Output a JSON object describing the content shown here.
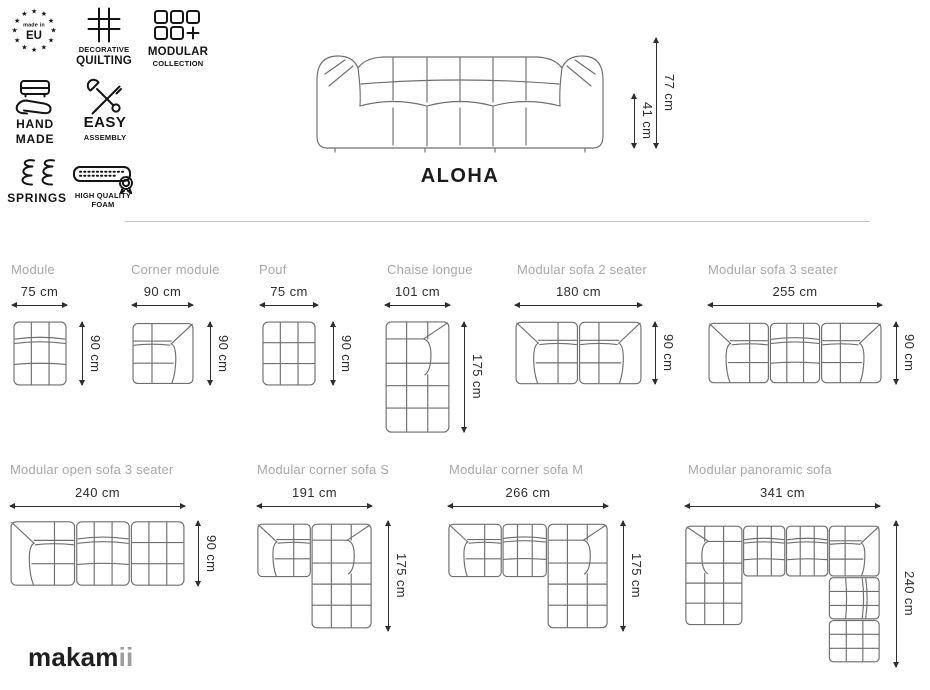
{
  "colors": {
    "line_art": "#6f6f6f",
    "icon_ink": "#141414",
    "dimension_text": "#2d2d2d",
    "label_gray": "#a8a8a8",
    "divider": "#c8c8c8",
    "logo_main_color": "#1f1f1f",
    "logo_suffix_color": "#9d9d9d"
  },
  "badges": [
    {
      "id": "made-in-eu",
      "line1": "made in",
      "line2": "EU"
    },
    {
      "id": "decorative-quilting",
      "line1": "DECORATIVE",
      "line2": "QUILTING"
    },
    {
      "id": "modular-collection",
      "line1": "MODULAR",
      "line2": "COLLECTION"
    },
    {
      "id": "hand-made",
      "line1": "HAND",
      "line2": "MADE"
    },
    {
      "id": "easy-assembly",
      "line1": "EASY",
      "line2": "ASSEMBLY"
    },
    {
      "id": "springs",
      "line1": "SPRINGS"
    },
    {
      "id": "high-quality-foam",
      "line1": "HIGH QUALITY",
      "line2": "FOAM"
    }
  ],
  "hero": {
    "title": "ALOHA",
    "total_height": "77 cm",
    "seat_height": "41 cm"
  },
  "products": [
    {
      "name": "Module",
      "width": "75 cm",
      "depth": "90 cm"
    },
    {
      "name": "Corner module",
      "width": "90 cm",
      "depth": "90 cm"
    },
    {
      "name": "Pouf",
      "width": "75 cm",
      "depth": "90 cm"
    },
    {
      "name": "Chaise longue",
      "width": "101 cm",
      "depth": "175 cm"
    },
    {
      "name": "Modular sofa 2 seater",
      "width": "180 cm",
      "depth": "90 cm"
    },
    {
      "name": "Modular sofa 3 seater",
      "width": "255 cm",
      "depth": "90 cm"
    },
    {
      "name": "Modular open sofa 3 seater",
      "width": "240 cm",
      "depth": "90 cm"
    },
    {
      "name": "Modular corner sofa S",
      "width": "191 cm",
      "depth": "175 cm"
    },
    {
      "name": "Modular corner sofa M",
      "width": "266 cm",
      "depth": "175 cm"
    },
    {
      "name": "Modular panoramic sofa",
      "width": "341 cm",
      "depth": "240 cm"
    }
  ],
  "brand": {
    "logo_main": "makam",
    "logo_suffix": "ii"
  }
}
